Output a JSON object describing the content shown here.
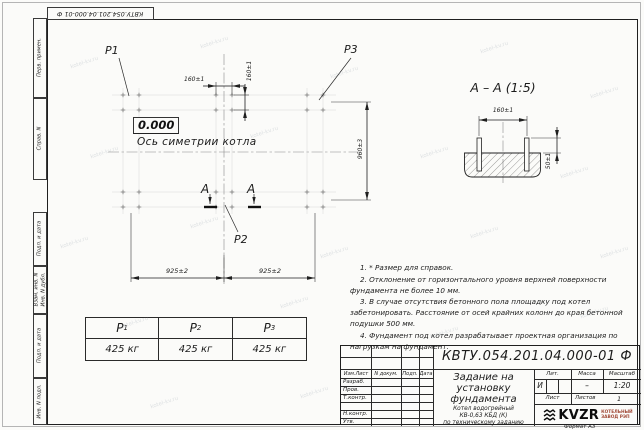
{
  "watermark": {
    "text": "kotel-kv.ru"
  },
  "top_stamp": {
    "text": "КВТУ.054.201.04.000-01  Ф"
  },
  "sidebar": {
    "perv": "Перв. примен.",
    "sprav": "Справ. N",
    "podp1": "Подп. и дата",
    "vzam": "Взам. инв. N",
    "inv_dubl": "Инв. N дубл.",
    "podp2": "Подп. и дата",
    "inv_podl": "Инв. N подл."
  },
  "plan": {
    "p1": "P1",
    "p2": "P2",
    "p3": "P3",
    "level": "0.000",
    "axis": "Ось симетрии котла",
    "dim_160h": "160±1",
    "dim_160v": "160±1",
    "dim_960": "960±3",
    "dim_925_left": "925±2",
    "dim_925_right": "925±2",
    "section_letter_left": "А",
    "section_letter_right": "А"
  },
  "section": {
    "title": "А – А (1:5)",
    "dim_160": "160±1",
    "dim_50": "50±1"
  },
  "notes": [
    "1. * Размер для справок.",
    "2. Отклонение от горизонтального уровня верхней поверхности фундамента не более 10 мм.",
    "3. В случае отсутствия бетонного пола площадку под котел забетонировать. Расстояние от осей крайних колонн до края бетонной подушки 500 мм.",
    "4. Фундамент под котел разрабатывает проектная организация по нагрузкам на фундамент."
  ],
  "load_table": {
    "headers": [
      {
        "base": "P",
        "sub": "1"
      },
      {
        "base": "P",
        "sub": "2"
      },
      {
        "base": "P",
        "sub": "3"
      }
    ],
    "values": [
      "425 кг",
      "425 кг",
      "425 кг"
    ]
  },
  "title_block": {
    "designation": "КВТУ.054.201.04.000-01  Ф",
    "rev_headers": {
      "izm": "Изм.Лист",
      "doc": "N докум.",
      "podp": "Подп.",
      "data": "Дата"
    },
    "roles": {
      "razrab": "Разраб.",
      "prov": "Пров.",
      "tkontr": "Т.контр.",
      "nkontr": "Н.контр.",
      "utv": "Утв."
    },
    "title_lines": [
      "Задание на",
      "установку",
      "фундамента"
    ],
    "subtitle_lines": [
      "Котел водогрейный",
      "КВ-0,63 КБД (К)",
      "по техническому заданию"
    ],
    "lit_label": "Лит.",
    "lit_value": "И",
    "mass_label": "Масса",
    "mass_value": "–",
    "scale_label": "Масштаб",
    "scale_value": "1:20",
    "sheet_label": "Лист",
    "sheets_label": "Листов",
    "sheets_value": "1",
    "logo_text": "KVZR",
    "logo_caption_lines": [
      "КОТЕЛЬНЫЙ",
      "ЗАВОД РЭП"
    ],
    "format_label": "Формат А3"
  }
}
